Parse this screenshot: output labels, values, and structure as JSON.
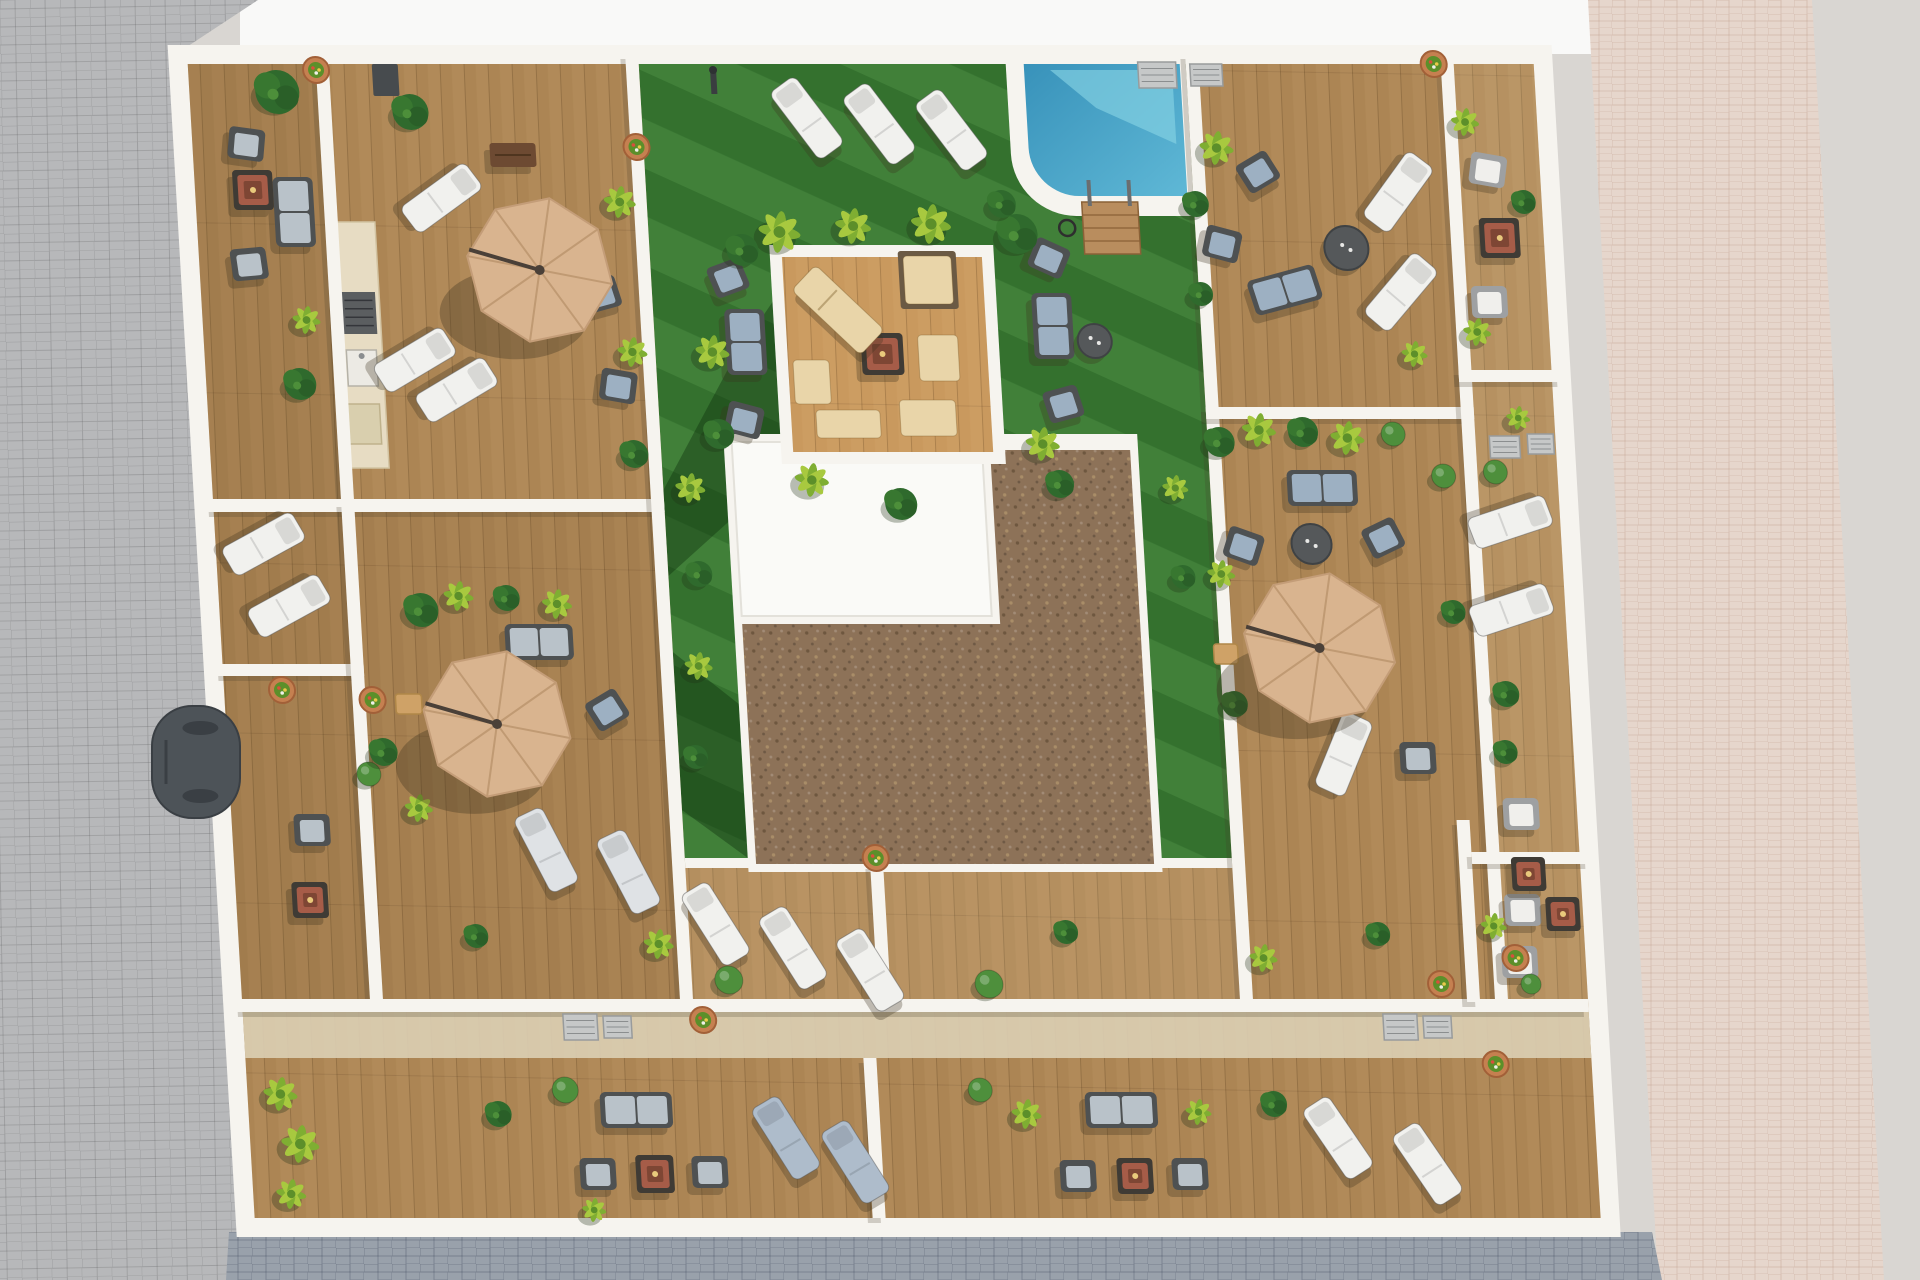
{
  "meta": {
    "description": "Aerial 3D architectural render: rooftop terraces of an apartment block with communal lawn, pool, wooden decks, parasols, sun loungers and planting"
  },
  "canvas": {
    "w": 1920,
    "h": 1280
  },
  "palette": {
    "bg": "#d9d6d2",
    "sky": "#f9f9f8",
    "street_left": "#b7b8ba",
    "street_bottom": "#99a1ab",
    "walk_pink": "#e6d6cc",
    "wall": "#f6f4ef",
    "deck": "#ac8554",
    "deck_light": "#c9995e",
    "band": "#dccfb4",
    "grass": "#3a7a33",
    "grass_dark": "rgba(10,42,10,0.38)",
    "gravel": "#8d7258",
    "gravel_dot1": "#6e573f",
    "gravel_dot2": "#a98d68",
    "roof_white": "#fafaf7",
    "pool": "#3f9ec6",
    "pool_light": "#86d3e4",
    "umbrella": "#d9b48f",
    "umbrella_seam": "#c09a73",
    "lounger_white": "#f1f1ee",
    "lounger_gray": "#dfe2e5",
    "lounger_blue": "#aebccb",
    "cushion_beige": "#e9d5a9",
    "sofa_dark": "#4e5152",
    "sofa_blue": "#9db0c2",
    "sofa_gray": "#b9c2c9",
    "fire_red": "#a65c48",
    "fire_frame": "#3f3b35",
    "table_dark": "#55585a",
    "wood_dark": "#6d4a32",
    "tan_table": "#cfa267",
    "ac": "#c6c8c8",
    "plant_dark": "#2f6a2d",
    "plant_mid": "#4d8f3a",
    "plant_yellow": "#a8c93f",
    "plant_yellow2": "#7fae32",
    "ball_green": "#4e8f3c",
    "planter": "#c58050",
    "car": "#4d5358",
    "shadow": "rgba(60,50,30,0.30)"
  },
  "background": {
    "sky": [
      240,
      0,
      1360,
      54
    ],
    "left_street": [
      [
        0,
        0
      ],
      [
        258,
        0
      ],
      [
        176,
        54
      ],
      [
        244,
        1280
      ],
      [
        0,
        1280
      ]
    ],
    "bottom_street": [
      [
        229,
        1232
      ],
      [
        1652,
        1232
      ],
      [
        1662,
        1280
      ],
      [
        226,
        1280
      ]
    ],
    "right_walk": [
      [
        1588,
        0
      ],
      [
        1812,
        0
      ],
      [
        1884,
        1280
      ],
      [
        1658,
        1280
      ]
    ]
  },
  "building": {
    "x": 175,
    "y": 52,
    "w": 1370,
    "h": 1178,
    "skew_deg": 3.32
  },
  "regions": {
    "courtyard": [
      463,
      12,
      547,
      800
    ],
    "core_white": [
      526,
      382,
      414,
      438
    ],
    "core_roof": [
      534,
      390,
      250,
      174
    ],
    "gravel_arm": [
      792,
      398,
      140,
      174
    ],
    "gravel_main": [
      534,
      572,
      398,
      240
    ],
    "grass_edge": [
      463,
      806,
      547,
      10
    ],
    "pool_surround": [
      830,
      12,
      180,
      152
    ],
    "pool_water": [
      848,
      12,
      156,
      132
    ],
    "pool_corner_r": 62,
    "pool_steps": [
      898,
      150,
      56,
      52
    ],
    "pool_hose": [
      882,
      176
    ],
    "platform_frame": [
      583,
      193,
      224,
      219
    ],
    "platform_inset": 12,
    "band": [
      12,
      960,
      1346,
      46
    ],
    "counter": {
      "rect": [
        148,
        170,
        42,
        246
      ],
      "bbq": [
        152,
        240,
        34,
        42
      ],
      "sink": [
        154,
        298,
        30,
        36
      ],
      "unit": [
        152,
        352,
        32,
        40
      ]
    },
    "tints": [
      [
        12,
        12,
        128,
        935,
        "rgba(70,45,20,0.10)"
      ],
      [
        153,
        460,
        297,
        487,
        "rgba(70,45,20,0.07)"
      ],
      [
        463,
        816,
        547,
        131,
        "rgba(255,235,195,0.10)"
      ],
      [
        1278,
        12,
        80,
        935,
        "rgba(255,238,200,0.12)"
      ]
    ],
    "grass_shadows": [
      [
        [
          583,
          250
        ],
        [
          583,
          412
        ],
        [
          526,
          470
        ],
        [
          463,
          524
        ],
        [
          463,
          438
        ],
        [
          540,
          308
        ]
      ],
      [
        [
          463,
          600
        ],
        [
          526,
          652
        ],
        [
          526,
          806
        ],
        [
          463,
          758
        ]
      ]
    ]
  },
  "walls": [
    [
      140,
      0,
      13,
      450
    ],
    [
      0,
      447,
      463,
      13
    ],
    [
      0,
      612,
      153,
      12
    ],
    [
      140,
      450,
      13,
      497
    ],
    [
      450,
      0,
      13,
      947
    ],
    [
      1010,
      0,
      13,
      947
    ],
    [
      1010,
      355,
      268,
      12
    ],
    [
      1265,
      0,
      13,
      950
    ],
    [
      1265,
      318,
      105,
      12
    ],
    [
      0,
      947,
      1358,
      13
    ],
    [
      630,
      1006,
      13,
      160
    ],
    [
      1237,
      768,
      13,
      182
    ],
    [
      1250,
      800,
      120,
      12
    ],
    [
      648,
      812,
      13,
      135
    ]
  ],
  "items": {
    "umbrellas": [
      [
        352,
        218,
        73
      ],
      [
        283,
        672,
        74
      ],
      [
        1110,
        596,
        76
      ]
    ],
    "beige_lounger": [
      648,
      258,
      -45
    ],
    "pads": [
      [
        740,
        228,
        48,
        48,
        1
      ],
      [
        746,
        306,
        40,
        46,
        0
      ],
      [
        732,
        366,
        56,
        36,
        0
      ],
      [
        652,
        372,
        64,
        28,
        0
      ],
      [
        618,
        330,
        36,
        44,
        0
      ]
    ],
    "loungers": [
      [
        628,
        66,
        -35,
        "w"
      ],
      [
        700,
        72,
        -35,
        "w"
      ],
      [
        772,
        78,
        -35,
        "w"
      ],
      [
        258,
        146,
        55,
        "w"
      ],
      [
        222,
        308,
        60,
        "w"
      ],
      [
        262,
        338,
        60,
        "w"
      ],
      [
        60,
        492,
        62,
        "w"
      ],
      [
        82,
        554,
        62,
        "w"
      ],
      [
        490,
        872,
        -30,
        "w"
      ],
      [
        566,
        896,
        -30,
        "w"
      ],
      [
        642,
        918,
        -30,
        "w"
      ],
      [
        325,
        798,
        -25,
        "g"
      ],
      [
        406,
        820,
        -25,
        "g"
      ],
      [
        548,
        1086,
        -30,
        "b"
      ],
      [
        616,
        1110,
        -30,
        "b"
      ],
      [
        1100,
        1086,
        -32,
        "w"
      ],
      [
        1188,
        1112,
        -32,
        "w"
      ],
      [
        1215,
        140,
        38,
        "w"
      ],
      [
        1212,
        240,
        42,
        "w"
      ],
      [
        1308,
        470,
        72,
        "w"
      ],
      [
        1304,
        558,
        72,
        "w"
      ],
      [
        1128,
        702,
        25,
        "w"
      ]
    ],
    "chairs": [
      [
        66,
        92,
        8,
        "g"
      ],
      [
        62,
        212,
        -5,
        "g"
      ],
      [
        92,
        778,
        0,
        "g"
      ],
      [
        540,
        226,
        -20,
        "b"
      ],
      [
        548,
        368,
        15,
        "b"
      ],
      [
        862,
        206,
        25,
        "b"
      ],
      [
        868,
        352,
        -15,
        "b"
      ],
      [
        412,
        242,
        -15,
        "b"
      ],
      [
        424,
        334,
        10,
        "b"
      ],
      [
        394,
        658,
        -30,
        "b"
      ],
      [
        1040,
        494,
        20,
        "b"
      ],
      [
        1180,
        486,
        -25,
        "b"
      ],
      [
        1076,
        120,
        -30,
        "b"
      ],
      [
        1036,
        192,
        15,
        "b"
      ],
      [
        358,
        1122,
        0,
        "g"
      ],
      [
        470,
        1120,
        0,
        "g"
      ],
      [
        838,
        1124,
        0,
        "g"
      ],
      [
        950,
        1122,
        0,
        "g"
      ],
      [
        1306,
        118,
        10,
        "w"
      ],
      [
        1300,
        250,
        0,
        "w"
      ],
      [
        1302,
        762,
        0,
        "w"
      ],
      [
        1298,
        858,
        0,
        "w"
      ],
      [
        1292,
        910,
        0,
        "w"
      ],
      [
        1202,
        706,
        0,
        "g"
      ]
    ],
    "sofas": [
      [
        554,
        290,
        30,
        58,
        0,
        "b"
      ],
      [
        862,
        274,
        30,
        58,
        0,
        "b"
      ],
      [
        110,
        160,
        30,
        62,
        0,
        "g"
      ],
      [
        330,
        590,
        58,
        28,
        0,
        "g"
      ],
      [
        400,
        1058,
        62,
        28,
        0,
        "g"
      ],
      [
        885,
        1058,
        62,
        28,
        0,
        "g"
      ],
      [
        1122,
        436,
        60,
        28,
        0,
        "b"
      ],
      [
        1096,
        238,
        60,
        28,
        -15,
        "b"
      ]
    ],
    "fires": [
      [
        70,
        138,
        40
      ],
      [
        86,
        848,
        36
      ],
      [
        415,
        1122,
        38
      ],
      [
        895,
        1124,
        36
      ],
      [
        1314,
        186,
        40
      ],
      [
        1306,
        822,
        34
      ],
      [
        1338,
        862,
        34
      ],
      [
        690,
        302,
        42
      ]
    ],
    "round_tables": [
      [
        903,
        289,
        17
      ],
      [
        1108,
        492,
        20
      ],
      [
        1160,
        196,
        22
      ]
    ],
    "side_tables": [
      [
        196,
        652,
        26,
        20
      ],
      [
        1016,
        602,
        24,
        20
      ]
    ],
    "benches": [
      [
        332,
        103,
        46,
        24
      ]
    ],
    "acs": [
      [
        332,
        962,
        34,
        26
      ],
      [
        372,
        964,
        28,
        22
      ],
      [
        1152,
        962,
        34,
        26
      ],
      [
        1192,
        964,
        28,
        22
      ],
      [
        962,
        10,
        38,
        26
      ],
      [
        1014,
        12,
        32,
        22
      ],
      [
        1292,
        384,
        30,
        22
      ],
      [
        1330,
        382,
        26,
        20
      ]
    ],
    "boxes": [
      [
        196,
        12,
        26,
        32
      ]
    ],
    "poles": [
      [
        537,
        30
      ]
    ],
    "plants": [
      [
        594,
        180,
        21,
        "y"
      ],
      [
        668,
        174,
        18,
        "y"
      ],
      [
        746,
        172,
        20,
        "y"
      ],
      [
        832,
        182,
        20,
        "d"
      ],
      [
        556,
        198,
        16,
        "d"
      ],
      [
        520,
        300,
        17,
        "y"
      ],
      [
        522,
        382,
        15,
        "d"
      ],
      [
        845,
        392,
        17,
        "y"
      ],
      [
        612,
        428,
        17,
        "y"
      ],
      [
        700,
        452,
        16,
        "d"
      ],
      [
        860,
        432,
        14,
        "d"
      ],
      [
        490,
        436,
        15,
        "y"
      ],
      [
        494,
        522,
        13,
        "d"
      ],
      [
        488,
        614,
        14,
        "y"
      ],
      [
        480,
        705,
        12,
        "d"
      ],
      [
        975,
        436,
        13,
        "y"
      ],
      [
        978,
        525,
        12,
        "d"
      ],
      [
        500,
        928,
        14,
        "b"
      ],
      [
        760,
        932,
        14,
        "b"
      ],
      [
        840,
        880,
        12,
        "d"
      ],
      [
        436,
        150,
        16,
        "y"
      ],
      [
        440,
        300,
        15,
        "y"
      ],
      [
        436,
        402,
        14,
        "d"
      ],
      [
        232,
        60,
        18,
        "d"
      ],
      [
        100,
        40,
        22,
        "d"
      ],
      [
        116,
        268,
        14,
        "y"
      ],
      [
        106,
        332,
        16,
        "d"
      ],
      [
        214,
        558,
        17,
        "d"
      ],
      [
        252,
        544,
        15,
        "y"
      ],
      [
        300,
        546,
        13,
        "d"
      ],
      [
        350,
        552,
        15,
        "y"
      ],
      [
        152,
        722,
        12,
        "b"
      ],
      [
        200,
        756,
        14,
        "y"
      ],
      [
        250,
        884,
        12,
        "d"
      ],
      [
        432,
        892,
        15,
        "y"
      ],
      [
        168,
        700,
        14,
        "d"
      ],
      [
        45,
        1042,
        17,
        "y"
      ],
      [
        62,
        1092,
        19,
        "y"
      ],
      [
        50,
        1142,
        15,
        "y"
      ],
      [
        330,
        1038,
        13,
        "b"
      ],
      [
        352,
        1158,
        12,
        "y"
      ],
      [
        262,
        1062,
        13,
        "d"
      ],
      [
        790,
        1062,
        15,
        "y"
      ],
      [
        962,
        1060,
        13,
        "y"
      ],
      [
        745,
        1038,
        12,
        "b"
      ],
      [
        1038,
        1052,
        13,
        "d"
      ],
      [
        1022,
        390,
        15,
        "d"
      ],
      [
        1062,
        378,
        17,
        "y"
      ],
      [
        1106,
        380,
        15,
        "d"
      ],
      [
        1150,
        386,
        17,
        "y"
      ],
      [
        1196,
        382,
        12,
        "b"
      ],
      [
        1244,
        424,
        12,
        "b"
      ],
      [
        1016,
        522,
        14,
        "y"
      ],
      [
        1022,
        652,
        13,
        "d"
      ],
      [
        1036,
        906,
        14,
        "y"
      ],
      [
        1152,
        882,
        12,
        "d"
      ],
      [
        1246,
        560,
        12,
        "d"
      ],
      [
        1036,
        96,
        17,
        "y"
      ],
      [
        1012,
        152,
        13,
        "d"
      ],
      [
        1012,
        242,
        12,
        "d"
      ],
      [
        1222,
        302,
        13,
        "y"
      ],
      [
        1286,
        70,
        14,
        "y"
      ],
      [
        1340,
        150,
        12,
        "d"
      ],
      [
        1286,
        280,
        14,
        "y"
      ],
      [
        1296,
        420,
        12,
        "b"
      ],
      [
        1322,
        366,
        12,
        "y"
      ],
      [
        1294,
        642,
        13,
        "d"
      ],
      [
        1290,
        700,
        12,
        "d"
      ],
      [
        1268,
        874,
        13,
        "y"
      ],
      [
        1302,
        932,
        10,
        "b"
      ],
      [
        818,
        152,
        14,
        "d"
      ]
    ],
    "planters": [
      [
        140,
        18
      ],
      [
        456,
        95
      ],
      [
        160,
        648
      ],
      [
        654,
        806
      ],
      [
        472,
        968
      ],
      [
        1262,
        1012
      ],
      [
        1258,
        12
      ],
      [
        1212,
        932
      ],
      [
        1288,
        906
      ],
      [
        70,
        638
      ]
    ]
  },
  "car": {
    "x": 152,
    "y": 706,
    "w": 88,
    "h": 112
  }
}
